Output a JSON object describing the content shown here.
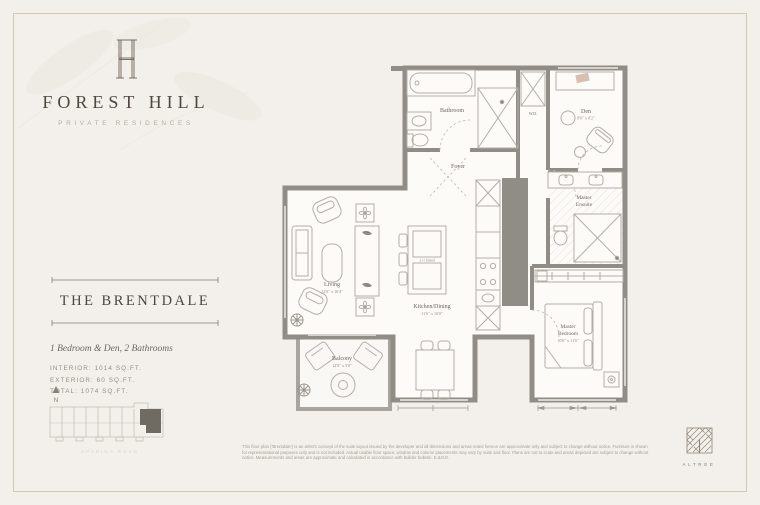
{
  "brand": {
    "name": "FOREST HILL",
    "tagline": "PRIVATE RESIDENCES"
  },
  "unit": {
    "name": "THE BRENTDALE",
    "description": "1 Bedroom & Den, 2 Bathrooms",
    "interior": "INTERIOR: 1014 SQ.FT.",
    "exterior": "EXTERIOR: 60 SQ.FT.",
    "total": "TOTAL: 1074 SQ.FT."
  },
  "keyplan": {
    "north": "N",
    "street": "SPADINA ROAD"
  },
  "floorplan": {
    "labels": {
      "bathroom": "Bathroom",
      "wd": "W.D.",
      "den": "Den",
      "den_dim": "8'6\" x 8'2\"",
      "foyer": "Foyer",
      "ensuite_line1": "Master",
      "ensuite_line2": "Ensuite",
      "bedroom_line1": "Master",
      "bedroom_line2": "Bedroom",
      "bedroom_dim": "10'6\" x 11'6\"",
      "living": "Living",
      "living_dim": "12'0\" x 16'4\"",
      "kitchen": "Kitchen/Dining",
      "kitchen_dim": "11'6\" x 16'0\"",
      "island": "2+1 Island",
      "balcony": "Balcony",
      "balcony_dim": "12'0\" x 5'0\""
    }
  },
  "footer": {
    "disclaimer_lines": [
      "This floor plan ('Brentdale') is an artist's concept of the suite layout issued by the developer and all dimensions and areas noted hereon are approximate only and subject to change without notice. Furniture is shown",
      "for representational purposes only and is not included. Actual usable floor space, window and column placements may vary by suite and floor. Plans are not to scale and areas depicted are subject to change without",
      "notice. Measurements and areas are approximate and calculated in accordance with builder bulletin. E.&O.E."
    ],
    "developer": "ALTREE"
  },
  "colors": {
    "background": "#f3f0ec",
    "frame": "#d3c7b6",
    "wall": "#908c86",
    "heading": "#4c443d",
    "tagline": "#b9ac9b"
  }
}
